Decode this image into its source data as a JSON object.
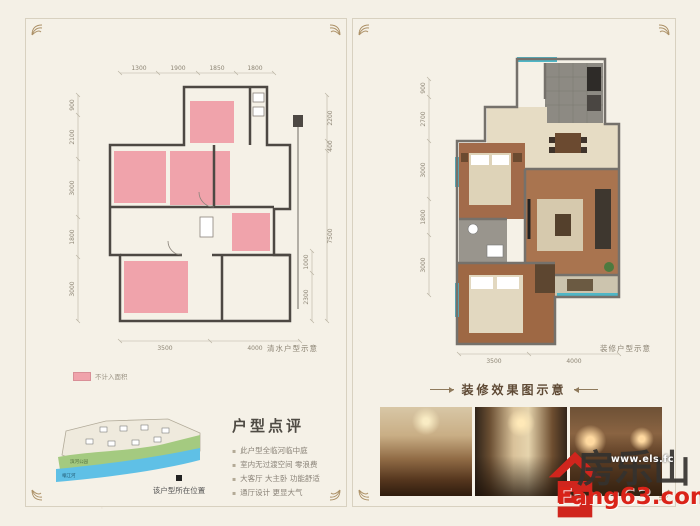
{
  "page": {
    "background": "#f4f0e6",
    "panel_border": "#d8d1c0",
    "accent_pink": "#f0a3ab",
    "accent_teal": "#4fb6c6",
    "accent_red": "#d0251d"
  },
  "watermark": {
    "text": "房乐山"
  },
  "left_panel": {
    "plan_label": "清水户型示意",
    "legend_label": "不计入面积",
    "dims": {
      "top": [
        "1300",
        "1900",
        "1850",
        "1800"
      ],
      "left": [
        "900",
        "2100",
        "3000",
        "1800",
        "3000"
      ],
      "right_outer": [
        "2200",
        "400",
        "7500"
      ],
      "right_inner": [
        "1000",
        "2300"
      ],
      "bottom": [
        "3500",
        "4000"
      ]
    },
    "map": {
      "park_label": "滨河公园",
      "river_label": "岷江河",
      "marker_label": "该户型所在位置"
    },
    "review": {
      "title": "户型点评",
      "bullets": [
        "此户型全临河临中庭",
        "室内无过渡空间 零浪费",
        "大客厅 大主卧 功能舒适",
        "通厅设计 更显大气"
      ]
    }
  },
  "right_panel": {
    "plan_label": "装修户型示意",
    "dims": {
      "left": [
        "900",
        "2700",
        "3000",
        "1800",
        "3000"
      ],
      "bottom": [
        "3500",
        "4000"
      ]
    },
    "gallery_title": "装修效果图示意"
  },
  "logo": {
    "cn": "房乐山",
    "url_overlay": "www.els.fc",
    "site": "Fang63.com"
  }
}
